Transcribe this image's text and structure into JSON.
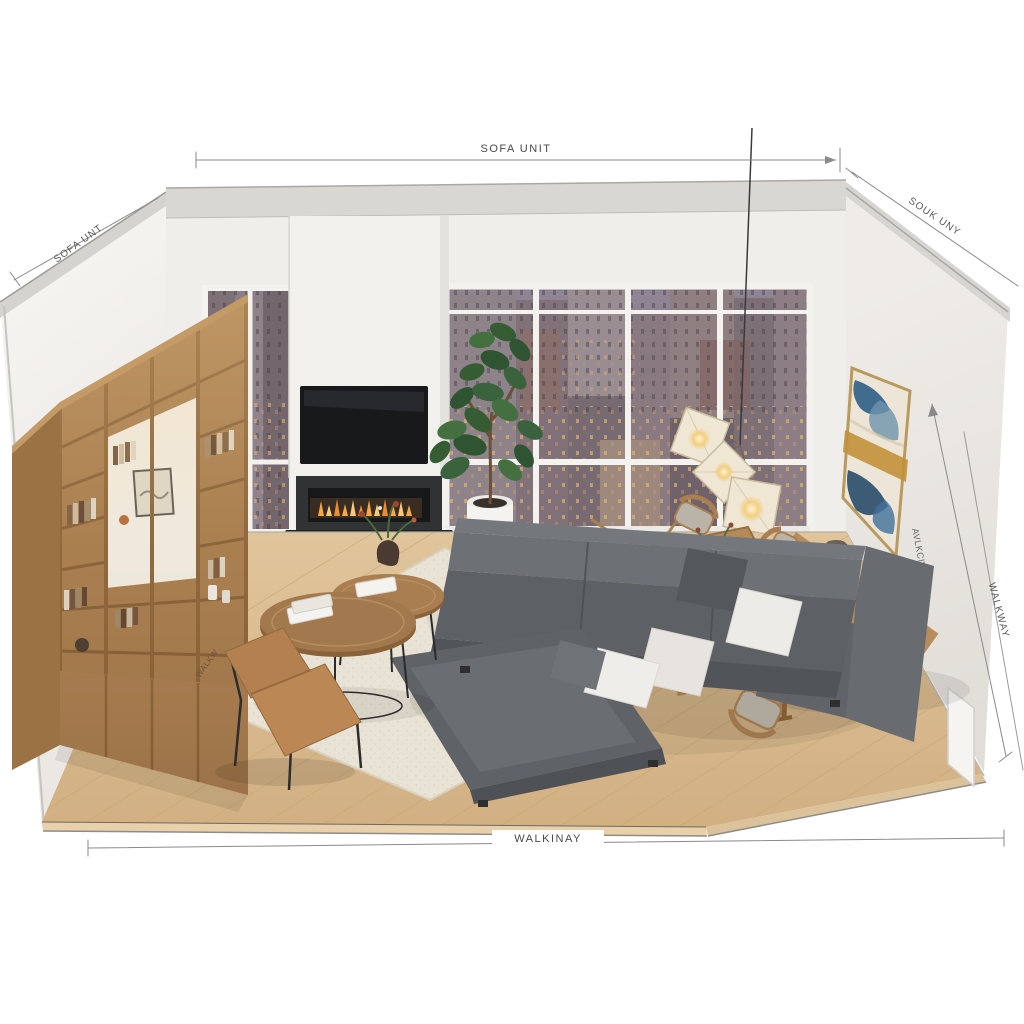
{
  "annotations": {
    "dim_top": "SOFA UNIT",
    "dim_left": "SOFA UNT",
    "dim_right_top": "SOUK UNY",
    "dim_right_inner": "AVLKCIV",
    "dim_right_outer": "WALKWAY",
    "dim_bottom": "WALKINAY",
    "floor_note": "WALKW"
  },
  "palette": {
    "wall": "#f1efec",
    "fascia": "#d8d7d4",
    "wood_cabinet": "#b4875a",
    "wood_floor": "#d7b88c",
    "rug": "#e9e3d6",
    "sofa": "#5d6064",
    "leather_chair": "#bb8754",
    "dining_wood": "#b58a58",
    "art_blue": "#2e5f86",
    "art_gold": "#c2913a",
    "flame_orange": "#f7a844",
    "city_dusk": "#8d8190",
    "pendant_shade": "#efe6d3"
  }
}
